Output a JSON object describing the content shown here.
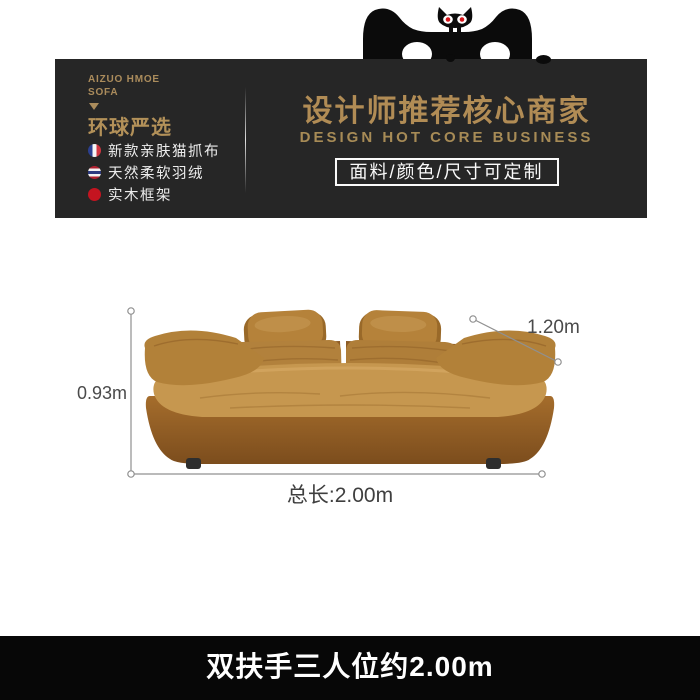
{
  "banner": {
    "brand": {
      "line1": "AIZUO HMOE",
      "line2": "SOFA",
      "slogan": "环球严选",
      "features": [
        {
          "icon": "france-flag-icon",
          "label": "新款亲肤猫抓布"
        },
        {
          "icon": "thailand-flag-icon",
          "label": "天然柔软羽绒"
        },
        {
          "icon": "red-dot-icon",
          "label": "实木框架"
        }
      ]
    },
    "headline": {
      "title": "设计师推荐核心商家",
      "subtitle": "DESIGN HOT CORE BUSINESS",
      "badge": "面料/颜色/尺寸可定制"
    }
  },
  "dims": {
    "height": "0.93m",
    "depth": "1.20m",
    "length": "总长:2.00m"
  },
  "footer": {
    "caption": "双扶手三人位约2.00m"
  },
  "colors": {
    "banner_bg": "#262626",
    "gold": "#b18c55",
    "badge_border": "#fafafa",
    "footer_bg": "#070707",
    "sofa_main": "#b5823c",
    "dim_line": "#909090"
  }
}
